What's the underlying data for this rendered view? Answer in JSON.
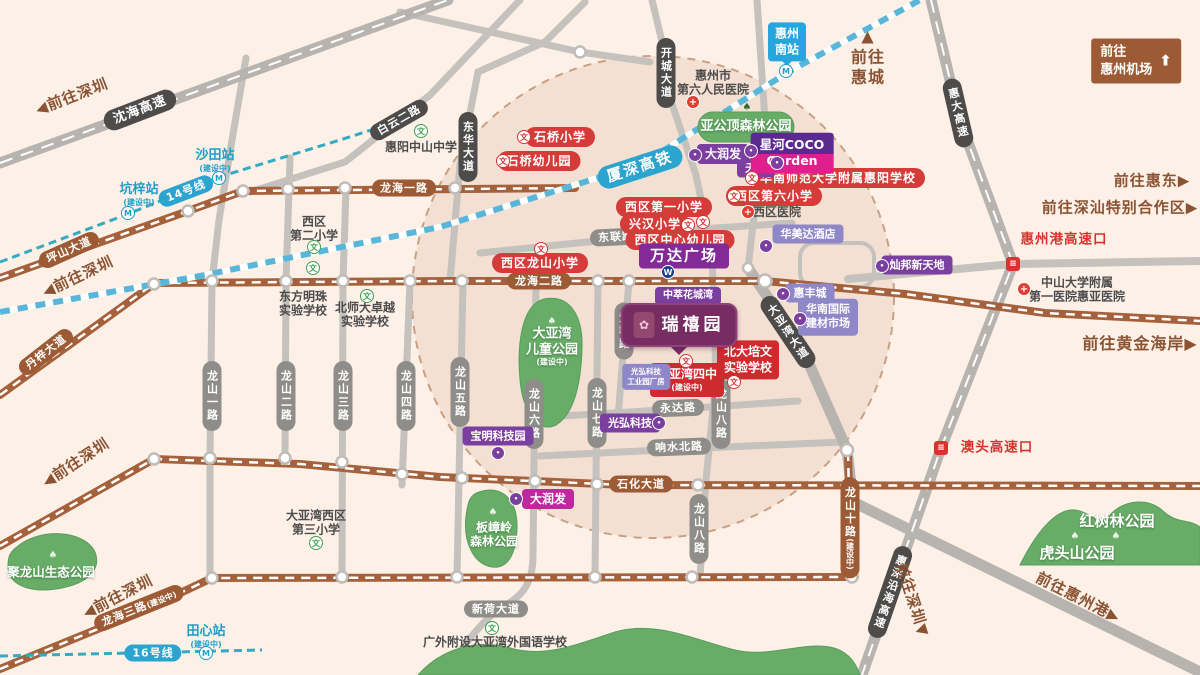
{
  "uc": "(建设中)",
  "icons": {
    "school": "文",
    "hospital": "+",
    "metro": "M",
    "shop": "•",
    "interchange": "≡",
    "tree": "♠",
    "wanda": "W",
    "arrow_up": "⬆"
  },
  "rail": {
    "hsr": "厦深高铁",
    "line14": "14号线",
    "line16": "16号线",
    "south_station_l1": "惠州",
    "south_station_l2": "南站",
    "shatian": "沙田站",
    "kengzi": "坑梓站",
    "tianxin": "田心站"
  },
  "roads": {
    "shenhai": "沈海高速",
    "baiyun": "白云二路",
    "donghua": "东华大道",
    "kaicheng": "开城大道",
    "huida": "惠大高速",
    "huishen": "惠深沿海高速",
    "dayawan": "大亚湾大道",
    "pingshan": "坪山大道",
    "danzi": "丹梓大道",
    "longhai1": "龙海一路",
    "longhai2": "龙海二路",
    "longhai3": "龙海三路",
    "shihua": "石化大道",
    "xinhe": "新荷大道",
    "donglian": "东联路",
    "yongda": "永达路",
    "xiangshui": "响水北路",
    "aiqun": "爱群路",
    "longshan1": "龙山一路",
    "longshan2": "龙山二路",
    "longshan3": "龙山三路",
    "longshan4": "龙山四路",
    "longshan5": "龙山五路",
    "longshan6": "龙山六路",
    "longshan7": "龙山七路",
    "longshan8": "龙山八路",
    "longshan10": "龙山十路"
  },
  "dirs": {
    "shenzhen": "◀前往深圳",
    "shenzhen_down": "前往深圳▼",
    "huicheng_arrow": "▲",
    "huicheng_l1": "前往",
    "huicheng_l2": "惠城",
    "airport_l1": "前往",
    "airport_l2": "惠州机场",
    "huidong": "前往惠东▶",
    "shenshan": "前往深汕特别合作区▶",
    "golden_coast": "前往黄金海岸▶",
    "huizhou_port": "前往惠州港▶",
    "port_exit": "惠州港高速口",
    "aotou_exit": "澳头高速口"
  },
  "schools": {
    "shiqiao": "石桥小学",
    "shiqiao_kg": "石桥幼儿园",
    "xiqu1": "西区第一小学",
    "xinghan": "兴汉小学",
    "xiqu_kg": "西区中心幼儿园",
    "xiqu_longshan": "西区龙山小学",
    "xiqu6": "西区第六小学",
    "hshnu": "华南师范大学附属惠阳学校",
    "beida_l1": "北大培文",
    "beida_l2": "实验学校",
    "dyw4_l1": "大亚湾四中",
    "huiyang_zs": "惠阳中山中学",
    "xiqu2_l1": "西区",
    "xiqu2_l2": "第二小学",
    "dfmz_l1": "东方明珠",
    "dfmz_l2": "实验学校",
    "bsd_l1": "北师大卓越",
    "bsd_l2": "实验学校",
    "dyw3_l1": "大亚湾西区",
    "dyw3_l2": "第三小学",
    "gwfs": "广外附设大亚湾外国语学校"
  },
  "medical": {
    "no6_l1": "惠州市",
    "no6_l2": "第六人民医院",
    "xiqu_hosp": "西区医院",
    "zsu_l1": "中山大学附属",
    "zsu_l2": "第一医院惠亚医院"
  },
  "biz": {
    "tianhong": "天虹",
    "rtmart": "大润发",
    "coco_l1": "星河COCO",
    "coco_l2": "Garden",
    "wanda": "万达广场",
    "ramada": "华美达酒店",
    "canbang": "灿邦新天地",
    "huifeng": "惠丰城",
    "jiancai_l1": "华南国际",
    "jiancai_l2": "建材市场",
    "zhongcui": "中萃花城湾",
    "baoming": "宝明科技园",
    "guanghong": "光弘科技",
    "gh_l1": "光弘科技",
    "gh_l2": "工业园厂房"
  },
  "parks": {
    "yagongding": "亚公顶森林公园",
    "children_l1": "大亚湾",
    "children_l2": "儿童公园",
    "julongshan": "聚龙山生态公园",
    "banzhang_l1": "板嶂岭",
    "banzhang_l2": "森林公园",
    "hongshulin": "红树林公园",
    "hutoushan": "虎头山公园"
  },
  "project": {
    "name": "瑞禧园",
    "logo": "✿"
  }
}
